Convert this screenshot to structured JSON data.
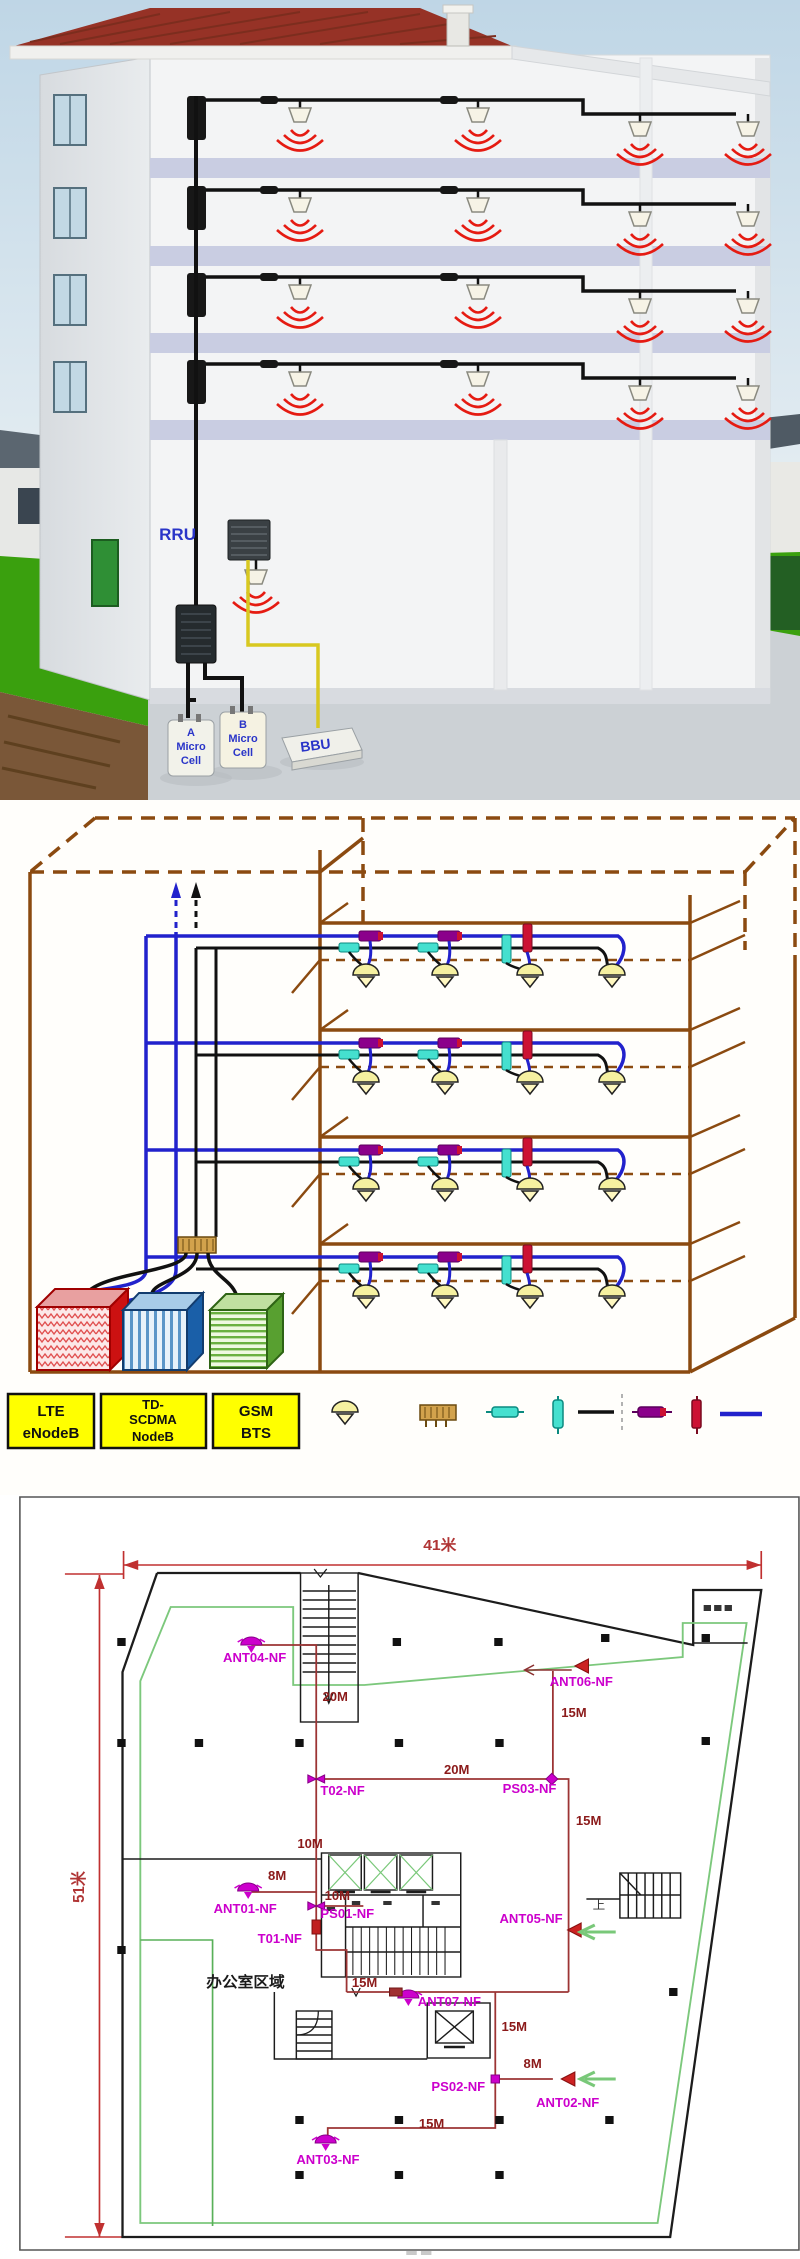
{
  "building_render": {
    "rru": "RRU",
    "micro_a": [
      "A",
      "Micro",
      "Cell"
    ],
    "micro_b": [
      "B",
      "Micro",
      "Cell"
    ],
    "bbu": "BBU"
  },
  "schematic": {
    "legend_boxes": [
      [
        "LTE",
        "eNodeB"
      ],
      [
        "TD-",
        "SCDMA",
        "NodeB"
      ],
      [
        "GSM",
        "BTS"
      ]
    ],
    "legend_symbols": [
      "ceiling-antenna",
      "power-combiner",
      "directional-coupler",
      "power-splitter",
      "feeder-cable",
      "coupler-type2",
      "splitter-type2",
      "jumper-cable"
    ],
    "colors": {
      "structure_brown": "#8B4A10",
      "blue_cable": "#2222cc",
      "black_cable": "#111111",
      "coupler_teal": "#45e0cf",
      "coupler_magenta": "#8B008B",
      "splitter_red": "#cc1133",
      "antenna_fill": "#f5f0a0",
      "lte_red": "#cc1111",
      "td_blue": "#1a5fa8",
      "gsm_green": "#58a030",
      "legend_yellow": "#ffff00"
    }
  },
  "floorplan": {
    "dim_width": "41米",
    "dim_height": "51米",
    "labels": [
      {
        "t": "41米",
        "x": 420,
        "y": 55,
        "c": "dim",
        "a": "middle"
      },
      {
        "t": "51米",
        "x": 80,
        "y": 392,
        "c": "dim",
        "a": "middle",
        "r": -90
      },
      {
        "t": "20M",
        "x": 308,
        "y": 206,
        "c": "len"
      },
      {
        "t": "20M",
        "x": 424,
        "y": 279,
        "c": "len"
      },
      {
        "t": "15M",
        "x": 536,
        "y": 222,
        "c": "len"
      },
      {
        "t": "15M",
        "x": 550,
        "y": 330,
        "c": "len"
      },
      {
        "t": "10M",
        "x": 284,
        "y": 353,
        "c": "len"
      },
      {
        "t": "8M",
        "x": 256,
        "y": 385,
        "c": "len"
      },
      {
        "t": "10M",
        "x": 310,
        "y": 405,
        "c": "len"
      },
      {
        "t": "15M",
        "x": 336,
        "y": 492,
        "c": "len"
      },
      {
        "t": "15M",
        "x": 479,
        "y": 536,
        "c": "len"
      },
      {
        "t": "8M",
        "x": 500,
        "y": 573,
        "c": "len"
      },
      {
        "t": "15M",
        "x": 400,
        "y": 633,
        "c": "len"
      },
      {
        "t": "ANT04-NF",
        "x": 213,
        "y": 167,
        "c": "ant"
      },
      {
        "t": "ANT06-NF",
        "x": 525,
        "y": 191,
        "c": "ant"
      },
      {
        "t": "T02-NF",
        "x": 306,
        "y": 300,
        "c": "ant"
      },
      {
        "t": "PS03-NF",
        "x": 480,
        "y": 298,
        "c": "ant"
      },
      {
        "t": "ANT01-NF",
        "x": 204,
        "y": 418,
        "c": "ant"
      },
      {
        "t": "PS01-NF",
        "x": 306,
        "y": 423,
        "c": "ant"
      },
      {
        "t": "T01-NF",
        "x": 246,
        "y": 448,
        "c": "ant"
      },
      {
        "t": "ANT05-NF",
        "x": 477,
        "y": 428,
        "c": "ant"
      },
      {
        "t": "办公室区域",
        "x": 197,
        "y": 492,
        "c": "room"
      },
      {
        "t": "ANT07-NF",
        "x": 399,
        "y": 511,
        "c": "ant"
      },
      {
        "t": "PS02-NF",
        "x": 412,
        "y": 596,
        "c": "ant"
      },
      {
        "t": "ANT02-NF",
        "x": 512,
        "y": 612,
        "c": "ant"
      },
      {
        "t": "ANT03-NF",
        "x": 283,
        "y": 669,
        "c": "ant"
      },
      {
        "t": "上",
        "x": 566,
        "y": 414,
        "c": "small"
      }
    ],
    "symbols": [
      {
        "type": "dome",
        "x": 240,
        "y": 150
      },
      {
        "type": "dome",
        "x": 237,
        "y": 396
      },
      {
        "type": "dome",
        "x": 390,
        "y": 503
      },
      {
        "type": "dome",
        "x": 311,
        "y": 648
      },
      {
        "type": "tri",
        "x": 549,
        "y": 171
      },
      {
        "type": "tri",
        "x": 542,
        "y": 435
      },
      {
        "type": "tri",
        "x": 536,
        "y": 584
      },
      {
        "type": "bowtie",
        "x": 302,
        "y": 284
      },
      {
        "type": "bowtie",
        "x": 302,
        "y": 411
      },
      {
        "type": "diam",
        "x": 527,
        "y": 284
      },
      {
        "type": "sq",
        "x": 473,
        "y": 584
      },
      {
        "type": "tap",
        "x": 378,
        "y": 497
      },
      {
        "type": "trect",
        "x": 302,
        "y": 432
      },
      {
        "type": "garrow",
        "x": 552,
        "y": 437
      },
      {
        "type": "garrow",
        "x": 552,
        "y": 584
      },
      {
        "type": "larrow",
        "x": 500,
        "y": 175
      }
    ],
    "columns": [
      [
        116,
        147
      ],
      [
        379,
        147
      ],
      [
        476,
        147
      ],
      [
        578,
        143
      ],
      [
        674,
        143
      ],
      [
        116,
        248
      ],
      [
        190,
        248
      ],
      [
        286,
        248
      ],
      [
        381,
        248
      ],
      [
        477,
        248
      ],
      [
        674,
        246
      ],
      [
        116,
        455
      ],
      [
        643,
        497
      ],
      [
        286,
        625
      ],
      [
        381,
        625
      ],
      [
        477,
        625
      ],
      [
        582,
        625
      ],
      [
        286,
        680
      ],
      [
        381,
        680
      ],
      [
        477,
        680
      ]
    ],
    "colors": {
      "wall": "#1c1c1c",
      "cable_red": "#9c3434",
      "dim_red": "#c03030",
      "antenna_magenta": "#cc00cc",
      "edge_green": "#7cc87c",
      "arrow_green": "#79c879"
    }
  }
}
